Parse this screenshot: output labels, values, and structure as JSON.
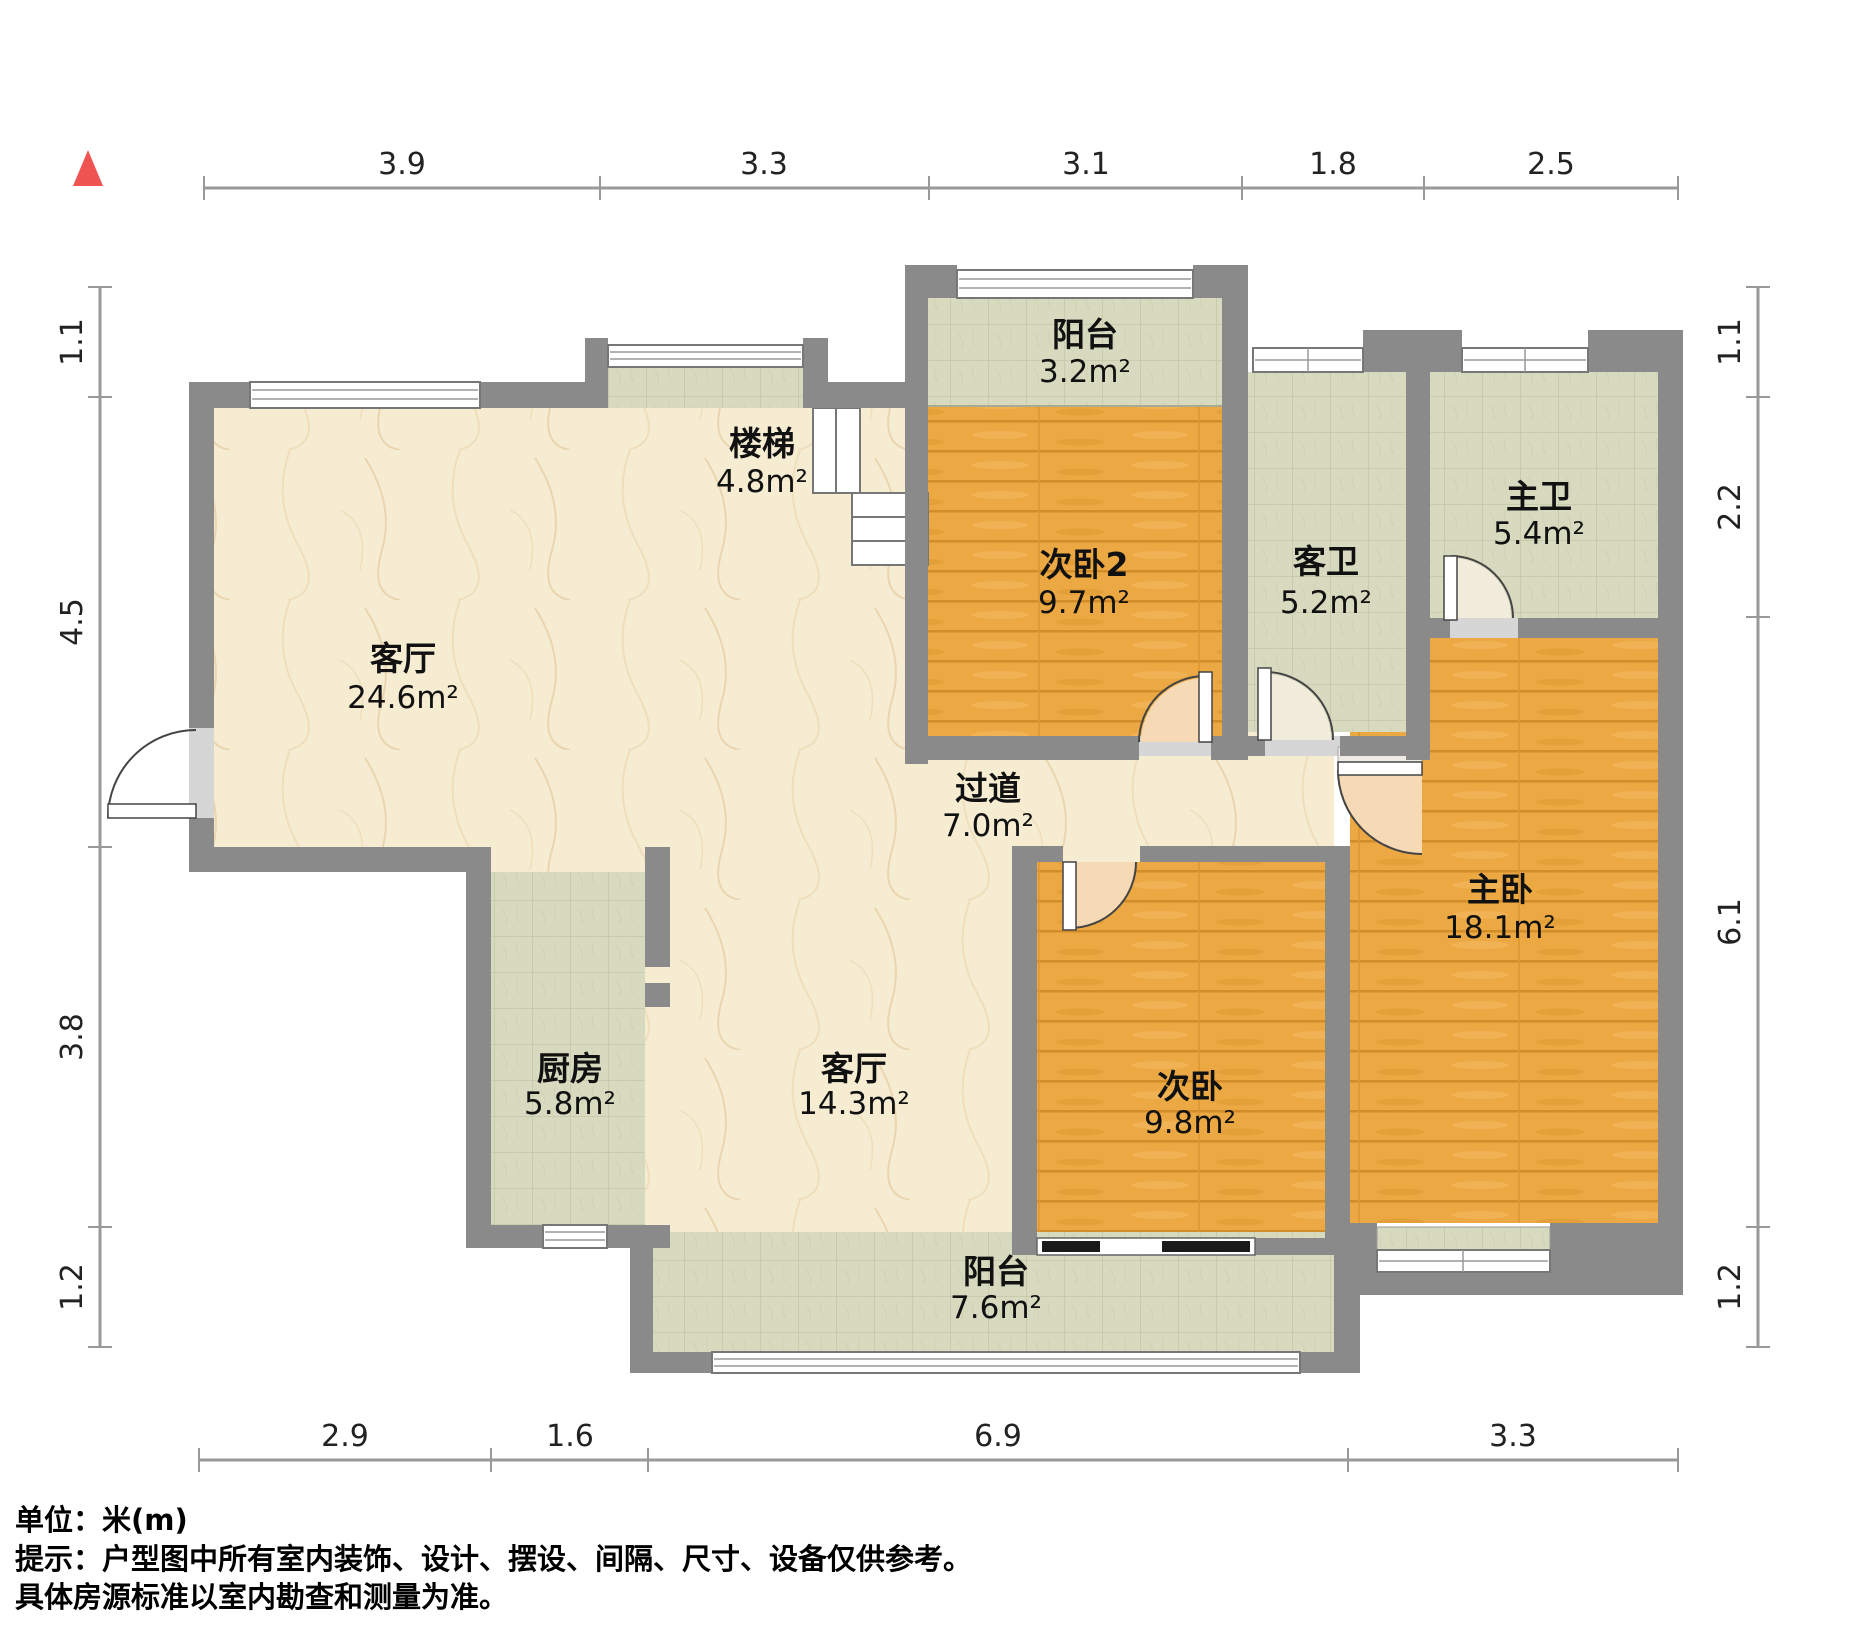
{
  "rooms": {
    "living_top": {
      "name": "客厅",
      "area": "24.6m²"
    },
    "stairs": {
      "name": "楼梯",
      "area": "4.8m²"
    },
    "balcony_top": {
      "name": "阳台",
      "area": "3.2m²"
    },
    "bedroom2": {
      "name": "次卧2",
      "area": "9.7m²"
    },
    "guest_bath": {
      "name": "客卫",
      "area": "5.2m²"
    },
    "master_bath": {
      "name": "主卫",
      "area": "5.4m²"
    },
    "hallway": {
      "name": "过道",
      "area": "7.0m²"
    },
    "kitchen": {
      "name": "厨房",
      "area": "5.8m²"
    },
    "dining": {
      "name": "客厅",
      "area": "14.3m²"
    },
    "bedroom3": {
      "name": "次卧",
      "area": "9.8m²"
    },
    "master_bedroom": {
      "name": "主卧",
      "area": "18.1m²"
    },
    "balcony_bottom": {
      "name": "阳台",
      "area": "7.6m²"
    }
  },
  "dimensions": {
    "top": [
      "3.9",
      "3.3",
      "3.1",
      "1.8",
      "2.5"
    ],
    "bottom": [
      "2.9",
      "1.6",
      "6.9",
      "3.3"
    ],
    "left": [
      "1.1",
      "4.5",
      "3.8",
      "1.2"
    ],
    "right": [
      "1.1",
      "2.2",
      "6.1",
      "1.2"
    ]
  },
  "footer": {
    "unit": "单位：米(m)",
    "tip": "提示：户型图中所有室内装饰、设计、摆设、间隔、尺寸、设备仅供参考。",
    "note": "具体房源标准以室内勘查和测量为准。"
  },
  "colors": {
    "wall": "#8a8a8a",
    "wood_floor": "#eca943",
    "tile_floor": "#d8dabf",
    "marble_floor": "#f6ecd2",
    "door_swing": "#f6d9b5",
    "north_arrow": "#ef5352",
    "dimension_line": "#999999"
  }
}
